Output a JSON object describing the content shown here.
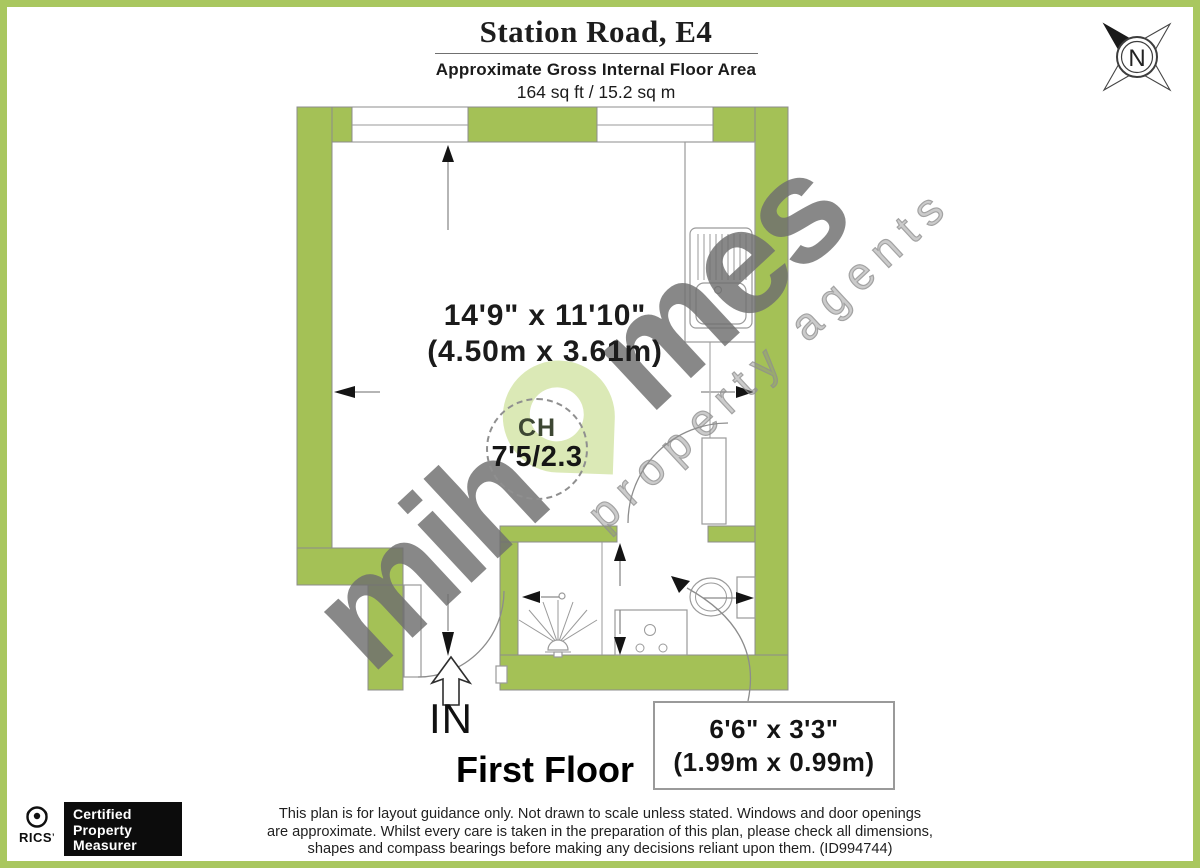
{
  "header": {
    "title": "Station Road, E4",
    "subtitle": "Approximate Gross Internal Floor Area",
    "area": "164 sq ft / 15.2 sq m"
  },
  "compass": {
    "label": "N"
  },
  "plan": {
    "room": {
      "dims_imperial": "14'9\" x 11'10\"",
      "dims_metric": "(4.50m x 3.61m)"
    },
    "ceiling_height": {
      "label": "CH",
      "value": "7'5/2.3"
    },
    "entrance_label": "IN",
    "floor_label": "First Floor",
    "bathroom_callout": {
      "dims_imperial": "6'6\" x 3'3\"",
      "dims_metric": "(1.99m x 0.99m)"
    }
  },
  "watermark": {
    "brand_prefix": "mih",
    "brand_suffix": "mes",
    "tagline": "property agents"
  },
  "footer": {
    "rics_label": "RICS",
    "rics_mark": "’",
    "certification": [
      "Certified",
      "Property",
      "Measurer"
    ],
    "disclaimer": [
      "This plan is for layout guidance only. Not drawn to scale unless stated. Windows and door openings",
      "are approximate. Whilst every care is taken in the preparation of this plan, please check all dimensions,",
      "shapes and compass bearings before making any decisions reliant upon them. (ID994744)"
    ]
  },
  "colors": {
    "wall_green": "#a4c156",
    "frame_green": "#a9c75f",
    "pin_green": "#d4e5a7",
    "watermark_gray": "#6f6f6f",
    "line_gray": "#8c8c8c"
  }
}
